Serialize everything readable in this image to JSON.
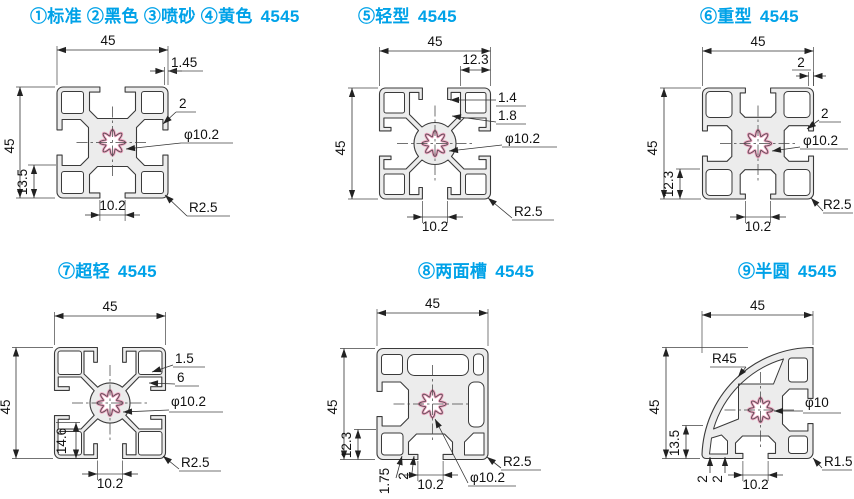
{
  "colors": {
    "title": "#00a2e8",
    "outline": "#3a3a3a",
    "profile_fill": "#ececec",
    "serration": "#f0a6c2"
  },
  "panels": [
    {
      "id": "1",
      "title": "①标准 ②黑色 ③喷砂 ④黄色",
      "code": "4545",
      "dims": {
        "w": "45",
        "h": "45",
        "t1": "1.45",
        "t2": "2",
        "hole": "φ10.2",
        "off": "13.5",
        "slot": "10.2",
        "r": "R2.5"
      }
    },
    {
      "id": "2",
      "title": "⑤轻型",
      "code": "4545",
      "dims": {
        "w": "45",
        "h": "45",
        "t1": "12.3",
        "t2": "1.4",
        "t3": "1.8",
        "hole": "φ10.2",
        "slot": "10.2",
        "r": "R2.5"
      }
    },
    {
      "id": "3",
      "title": "⑥重型",
      "code": "4545",
      "dims": {
        "w": "45",
        "h": "45",
        "t1": "2",
        "t2": "2",
        "hole": "φ10.2",
        "off": "12.3",
        "slot": "10.2",
        "r": "R2.5"
      }
    },
    {
      "id": "4",
      "title": "⑦超轻",
      "code": "4545",
      "dims": {
        "w": "45",
        "h": "45",
        "t1": "1.5",
        "t2": "6",
        "hole": "φ10.2",
        "off": "14.6",
        "slot": "10.2",
        "r": "R2.5"
      }
    },
    {
      "id": "5",
      "title": "⑧两面槽",
      "code": "4545",
      "dims": {
        "w": "45",
        "h": "45",
        "off": "12.3",
        "t1": "1.75",
        "t2": "2",
        "slot": "10.2",
        "hole": "φ10.2",
        "r": "R2.5"
      }
    },
    {
      "id": "6",
      "title": "⑨半圆",
      "code": "4545",
      "dims": {
        "w": "45",
        "h": "45",
        "arc": "R45",
        "hole": "φ10",
        "off": "13.5",
        "t1": "2",
        "t2": "2",
        "slot": "10.2",
        "r": "R1.5"
      }
    }
  ]
}
